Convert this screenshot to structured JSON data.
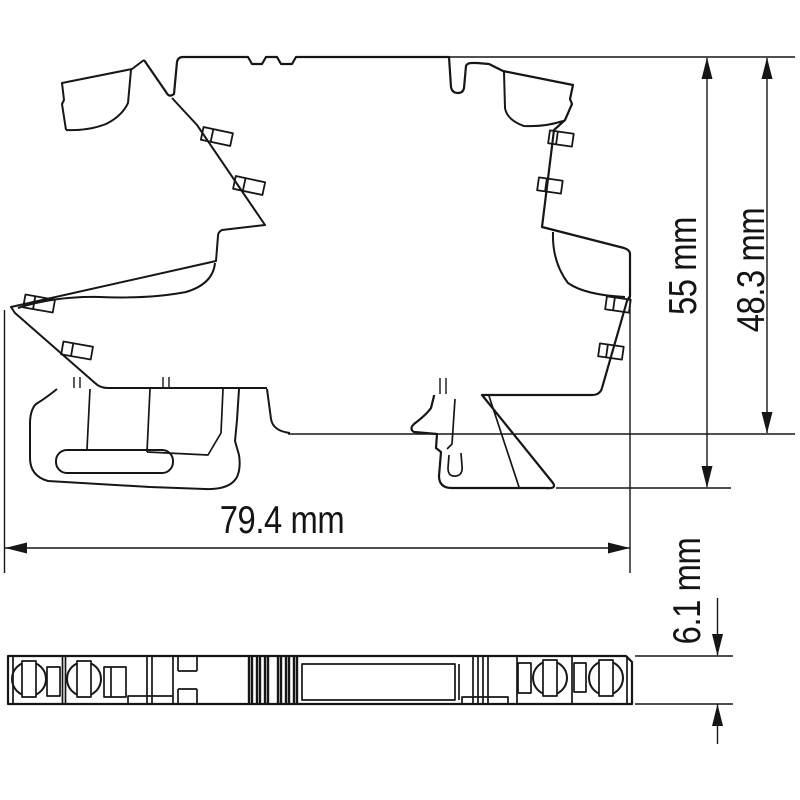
{
  "drawing": {
    "type": "technical-dimension-drawing",
    "views": {
      "side_view": "din-rail-module-side-profile",
      "bottom_view": "din-rail-module-bottom-strip"
    },
    "dimensions": {
      "overall_width": {
        "label": "79.4 mm",
        "orientation": "horizontal"
      },
      "overall_height": {
        "label": "55 mm",
        "orientation": "vertical"
      },
      "rail_height": {
        "label": "48.3 mm",
        "orientation": "vertical"
      },
      "module_depth": {
        "label": "6.1 mm",
        "orientation": "vertical"
      }
    },
    "colors": {
      "line": "#161616",
      "background": "#ffffff"
    }
  }
}
